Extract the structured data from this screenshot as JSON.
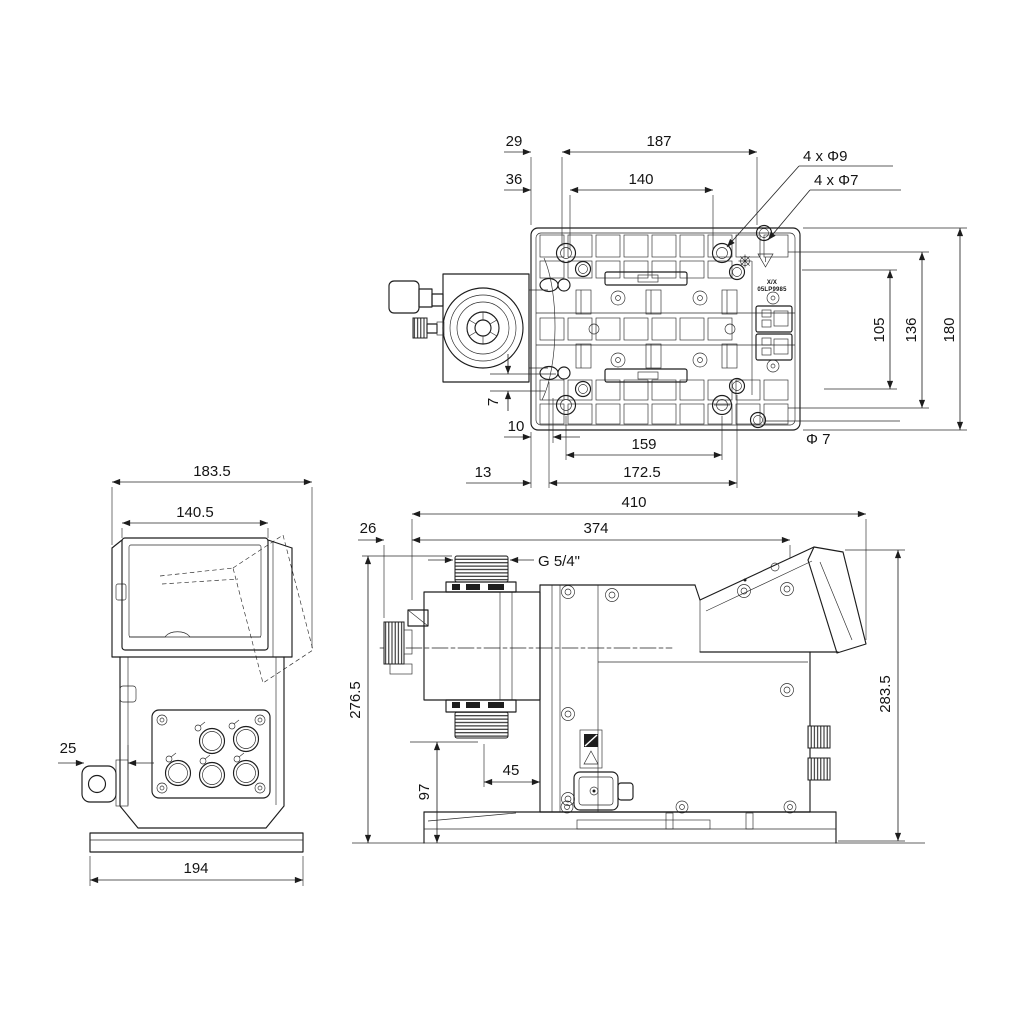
{
  "drawing": {
    "background": "#ffffff",
    "line_color": "#1d1d1d",
    "type": "technical dimensional drawing, 3 orthographic views of dosing pump"
  },
  "top_view": {
    "d29": "29",
    "d187": "187",
    "d36": "36",
    "d140": "140",
    "holes_9": "4 x Φ9",
    "holes_7": "4 x Φ7",
    "d105": "105",
    "d136": "136",
    "d180": "180",
    "d7": "7",
    "d10": "10",
    "d159": "159",
    "dia7": "Φ 7",
    "d13": "13",
    "d172_5": "172.5",
    "plate_label_top": "X/X",
    "plate_label_bottom": "05LP9985"
  },
  "front_view": {
    "d183_5": "183.5",
    "d140_5": "140.5",
    "d25": "25",
    "d194": "194"
  },
  "side_view": {
    "d410": "410",
    "d26": "26",
    "d374": "374",
    "thread": "G 5/4\"",
    "d276_5": "276.5",
    "d97": "97",
    "d45": "45",
    "d283_5": "283.5"
  }
}
